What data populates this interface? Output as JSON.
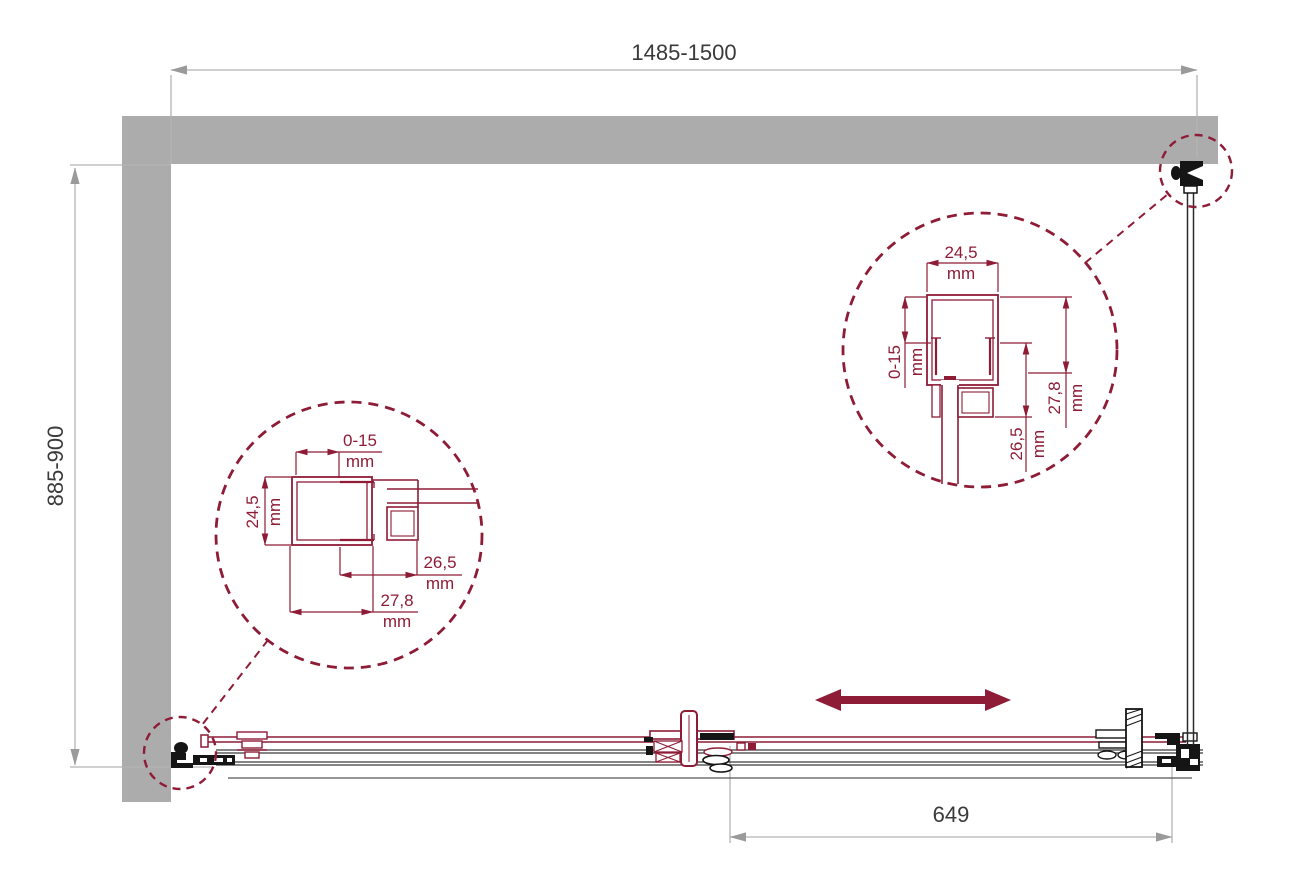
{
  "dimensions": {
    "overall_width": {
      "label": "1485-1500"
    },
    "overall_depth": {
      "label": "885-900"
    },
    "door_opening": {
      "label": "649"
    }
  },
  "detail_left": {
    "dim_top": {
      "value": "0-15",
      "unit": "mm"
    },
    "dim_left": {
      "value": "24,5",
      "unit": "mm"
    },
    "dim_mid": {
      "value": "26,5",
      "unit": "mm"
    },
    "dim_bottom": {
      "value": "27,8",
      "unit": "mm"
    }
  },
  "detail_right": {
    "dim_top": {
      "value": "24,5",
      "unit": "mm"
    },
    "dim_left": {
      "value": "0-15",
      "unit": "mm"
    },
    "dim_mid": {
      "value": "26,5",
      "unit": "mm"
    },
    "dim_right": {
      "value": "27,8",
      "unit": "mm"
    }
  },
  "colors": {
    "accent_maroon": "#8e1c36",
    "wall_gray": "#acacac",
    "dim_line_gray": "#b4b4b4",
    "ink_black": "#151515",
    "text_dark": "#3a3a3a"
  }
}
